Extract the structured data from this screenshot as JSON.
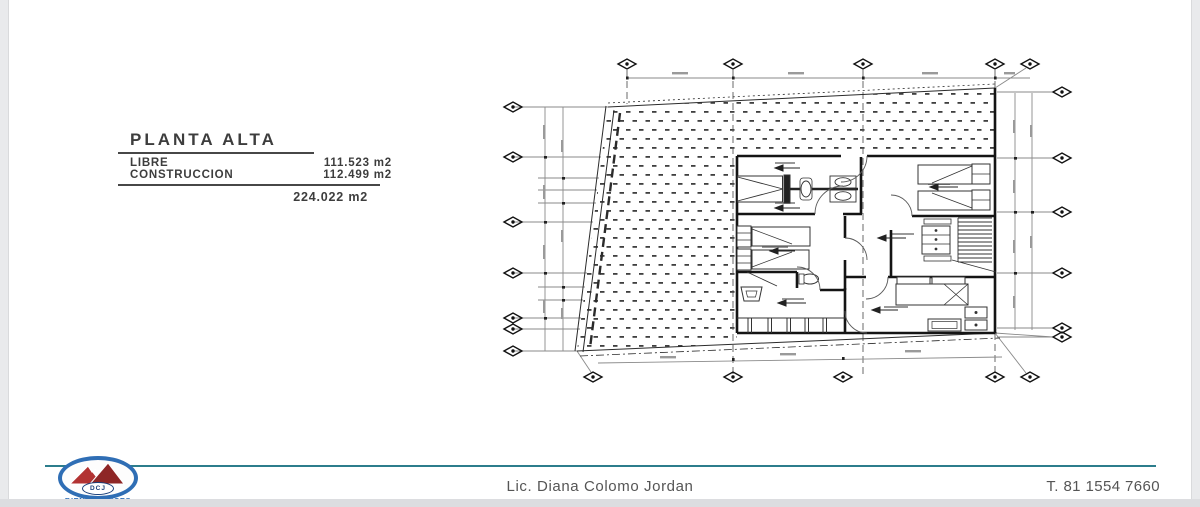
{
  "title_block": {
    "title": "PLANTA ALTA",
    "rows": [
      {
        "label": "LIBRE",
        "value": "111.523 m2"
      },
      {
        "label": "CONSTRUCCION",
        "value": "112.499 m2"
      }
    ],
    "total": "224.022 m2"
  },
  "drawing": {
    "type": "architectural-floor-plan",
    "ink_color": "#2b2b2b",
    "dimension_line_color": "#8a8a8a",
    "hatch_color": "#3f3f3f"
  },
  "footer": {
    "name": "Lic. Diana Colomo Jordan",
    "phone": "T. 81 1554 7660",
    "rule_color": "#2c7d8c",
    "logo": {
      "initials": "DCJ",
      "tagline": "BIENES RAICES",
      "ring_color": "#2f6eb5",
      "mountain_color": "#b23232",
      "text_color": "#1a3f7a"
    }
  }
}
